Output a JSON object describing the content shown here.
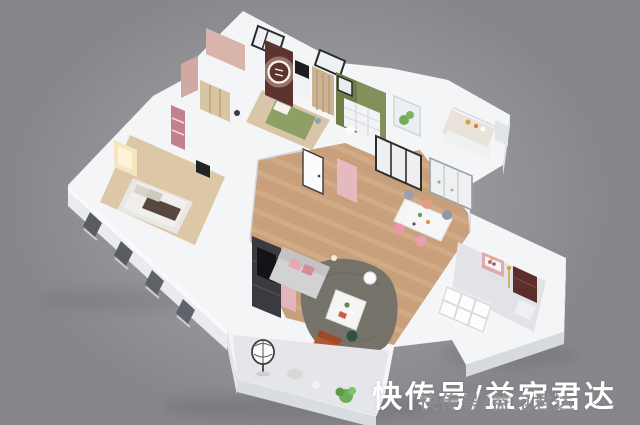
{
  "scene": {
    "alt": "3D isometric cutaway render of an apartment floor plan on a plain gray background"
  },
  "palette": {
    "background": "#87878b",
    "shell_white": "#f4f5f7",
    "wood_floor": "#c8a17c",
    "bedroom_floor": "#dcc7a6",
    "balcony_floor": "#e5e6ea",
    "rug": "#76736a",
    "accent_pink_wall": "#d9b4ab",
    "accent_rose_shelf": "#c5808f",
    "accent_maroon_wall": "#5d3332",
    "accent_olive_wall": "#6f7d48",
    "bed_green": "#8ea065",
    "curtain_tan": "#cbb294",
    "warm_lamp": "#f6e5bd",
    "sofa_gray": "#d2d2d4",
    "armchair_rust": "#b25831",
    "stool_pink": "#e698a6",
    "plant_green": "#6fae57"
  },
  "watermark": {
    "primary_text": "快传号/益宛君达",
    "primary_color": "#ffffff",
    "secondary_text": "快传号/益宛君达",
    "secondary_color": "#8e8e92"
  }
}
